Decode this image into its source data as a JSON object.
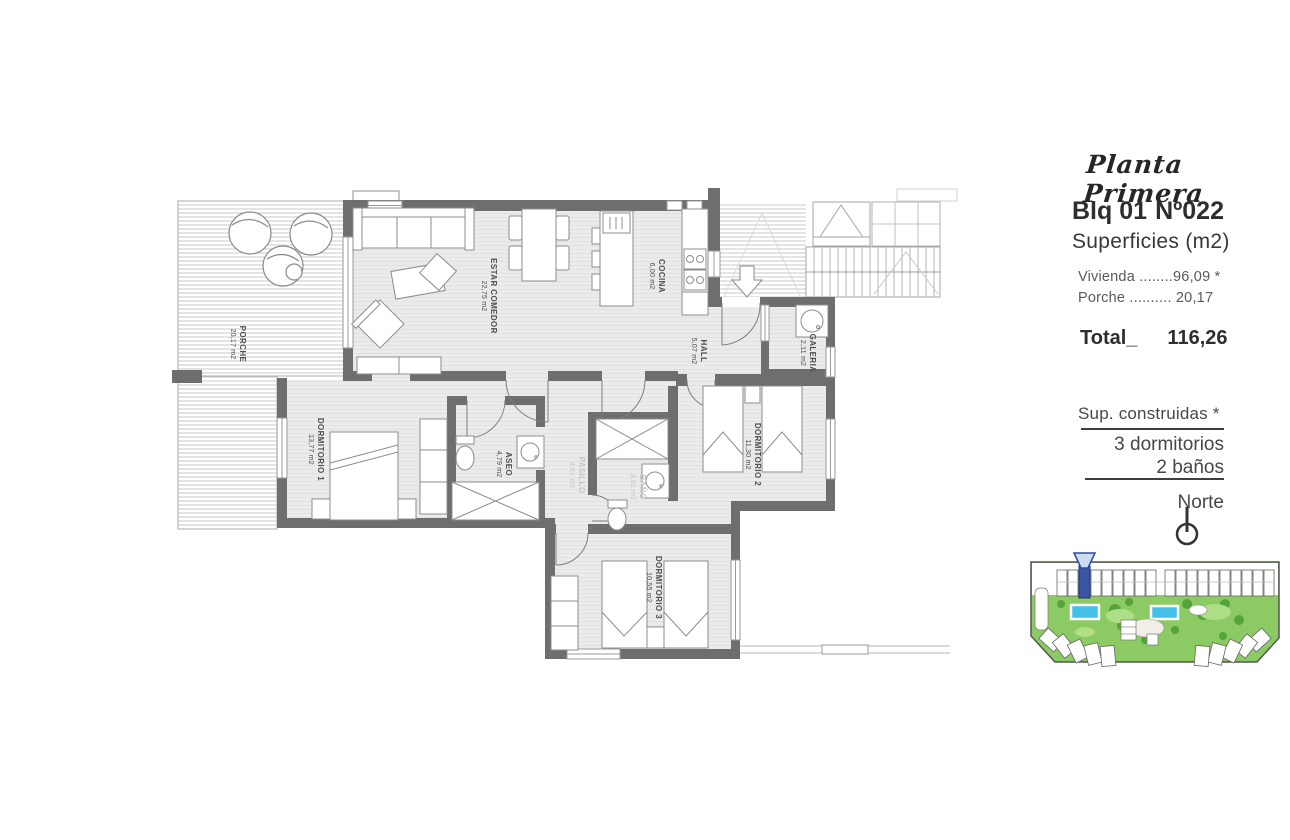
{
  "header": {
    "plan_name": "Planta Primera",
    "block": "Blq 01",
    "unit": "Nº022",
    "surfaces_title": "Superficies (m2)",
    "surface_rows": [
      {
        "label": "Vivienda",
        "dots": "........",
        "value": "96,09 *"
      },
      {
        "label": "Porche",
        "dots": "..........",
        "value": "20,17"
      }
    ],
    "total_label": "Total_",
    "total_value": "116,26"
  },
  "details": {
    "built_note": "Sup. construidas *",
    "bedrooms": "3 dormitorios",
    "bathrooms": "2 baños",
    "north_label": "Norte"
  },
  "floorplan": {
    "rooms": [
      {
        "id": "porche",
        "name": "PORCHE",
        "area": "20,17 m2"
      },
      {
        "id": "estar-comedor",
        "name": "ESTAR COMEDOR",
        "area": "22,75 m2"
      },
      {
        "id": "cocina",
        "name": "COCINA",
        "area": "6,00 m2"
      },
      {
        "id": "hall",
        "name": "HALL",
        "area": "5,07 m2"
      },
      {
        "id": "galeria",
        "name": "GALERIA",
        "area": "2,11 m2"
      },
      {
        "id": "dormitorio-1",
        "name": "DORMITORIO 1",
        "area": "13,77 m2"
      },
      {
        "id": "aseo",
        "name": "ASEO",
        "area": "4,79 m2"
      },
      {
        "id": "pasillo",
        "name": "PASILLO",
        "area": "3,61 m2"
      },
      {
        "id": "bano",
        "name": "BAÑO",
        "area": "3,61 m2"
      },
      {
        "id": "dormitorio-2",
        "name": "DORMITORIO 2",
        "area": "11,30 m2"
      },
      {
        "id": "dormitorio-3",
        "name": "DORMITORIO 3",
        "area": "10,55 m2"
      }
    ]
  },
  "colors": {
    "wall": "#6e6e6e",
    "floor": "#ebebeb",
    "thin_line": "#9c9c9c",
    "label_text": "#4f4f4f",
    "label_muted": "#c6c6c6",
    "map_green": "#8ccb63",
    "map_tree_green": "#55a33b",
    "map_pool_blue": "#43bfe8",
    "map_highlight_blue": "#3a55a5"
  }
}
